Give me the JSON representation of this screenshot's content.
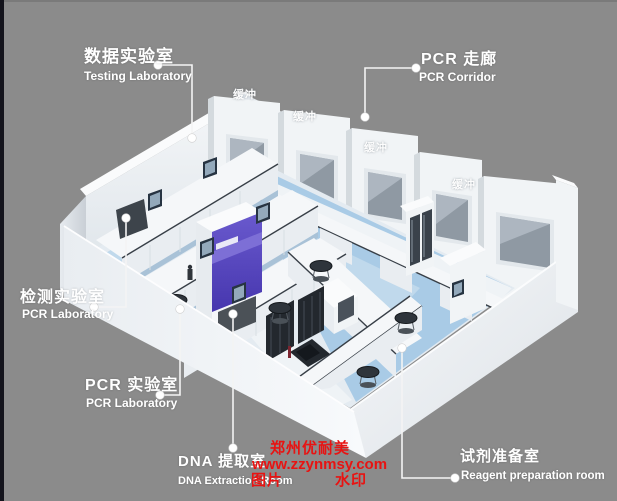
{
  "labels": {
    "testing": {
      "zh": "数据实验室",
      "en": "Testing Laboratory"
    },
    "corridor": {
      "zh": "PCR 走廊",
      "en": "PCR Corridor"
    },
    "inspection": {
      "zh": "检测实验室",
      "en": "PCR Laboratory"
    },
    "pcr": {
      "zh": "PCR 实验室",
      "en": "PCR Laboratory"
    },
    "dna": {
      "zh": "DNA 提取室",
      "en": "DNA Extraction Room"
    },
    "reagent": {
      "zh": "试剂准备室",
      "en": "Reagent preparation room"
    }
  },
  "buffers": [
    "缓冲",
    "缓冲",
    "缓冲",
    "缓冲"
  ],
  "watermark": {
    "company": "郑州优耐美",
    "url": "www.zzynmsy.com",
    "tag_left": "图片",
    "tag_right": "水印",
    "color": "#e81312"
  },
  "colors": {
    "background": "#8b8b8b",
    "left_strip": "#14141c",
    "wall_white": "#f1f4f6",
    "floor_blue": "#a9cbe6",
    "purple_cabinet": "#5143bd",
    "label_text": "#ffffff"
  }
}
